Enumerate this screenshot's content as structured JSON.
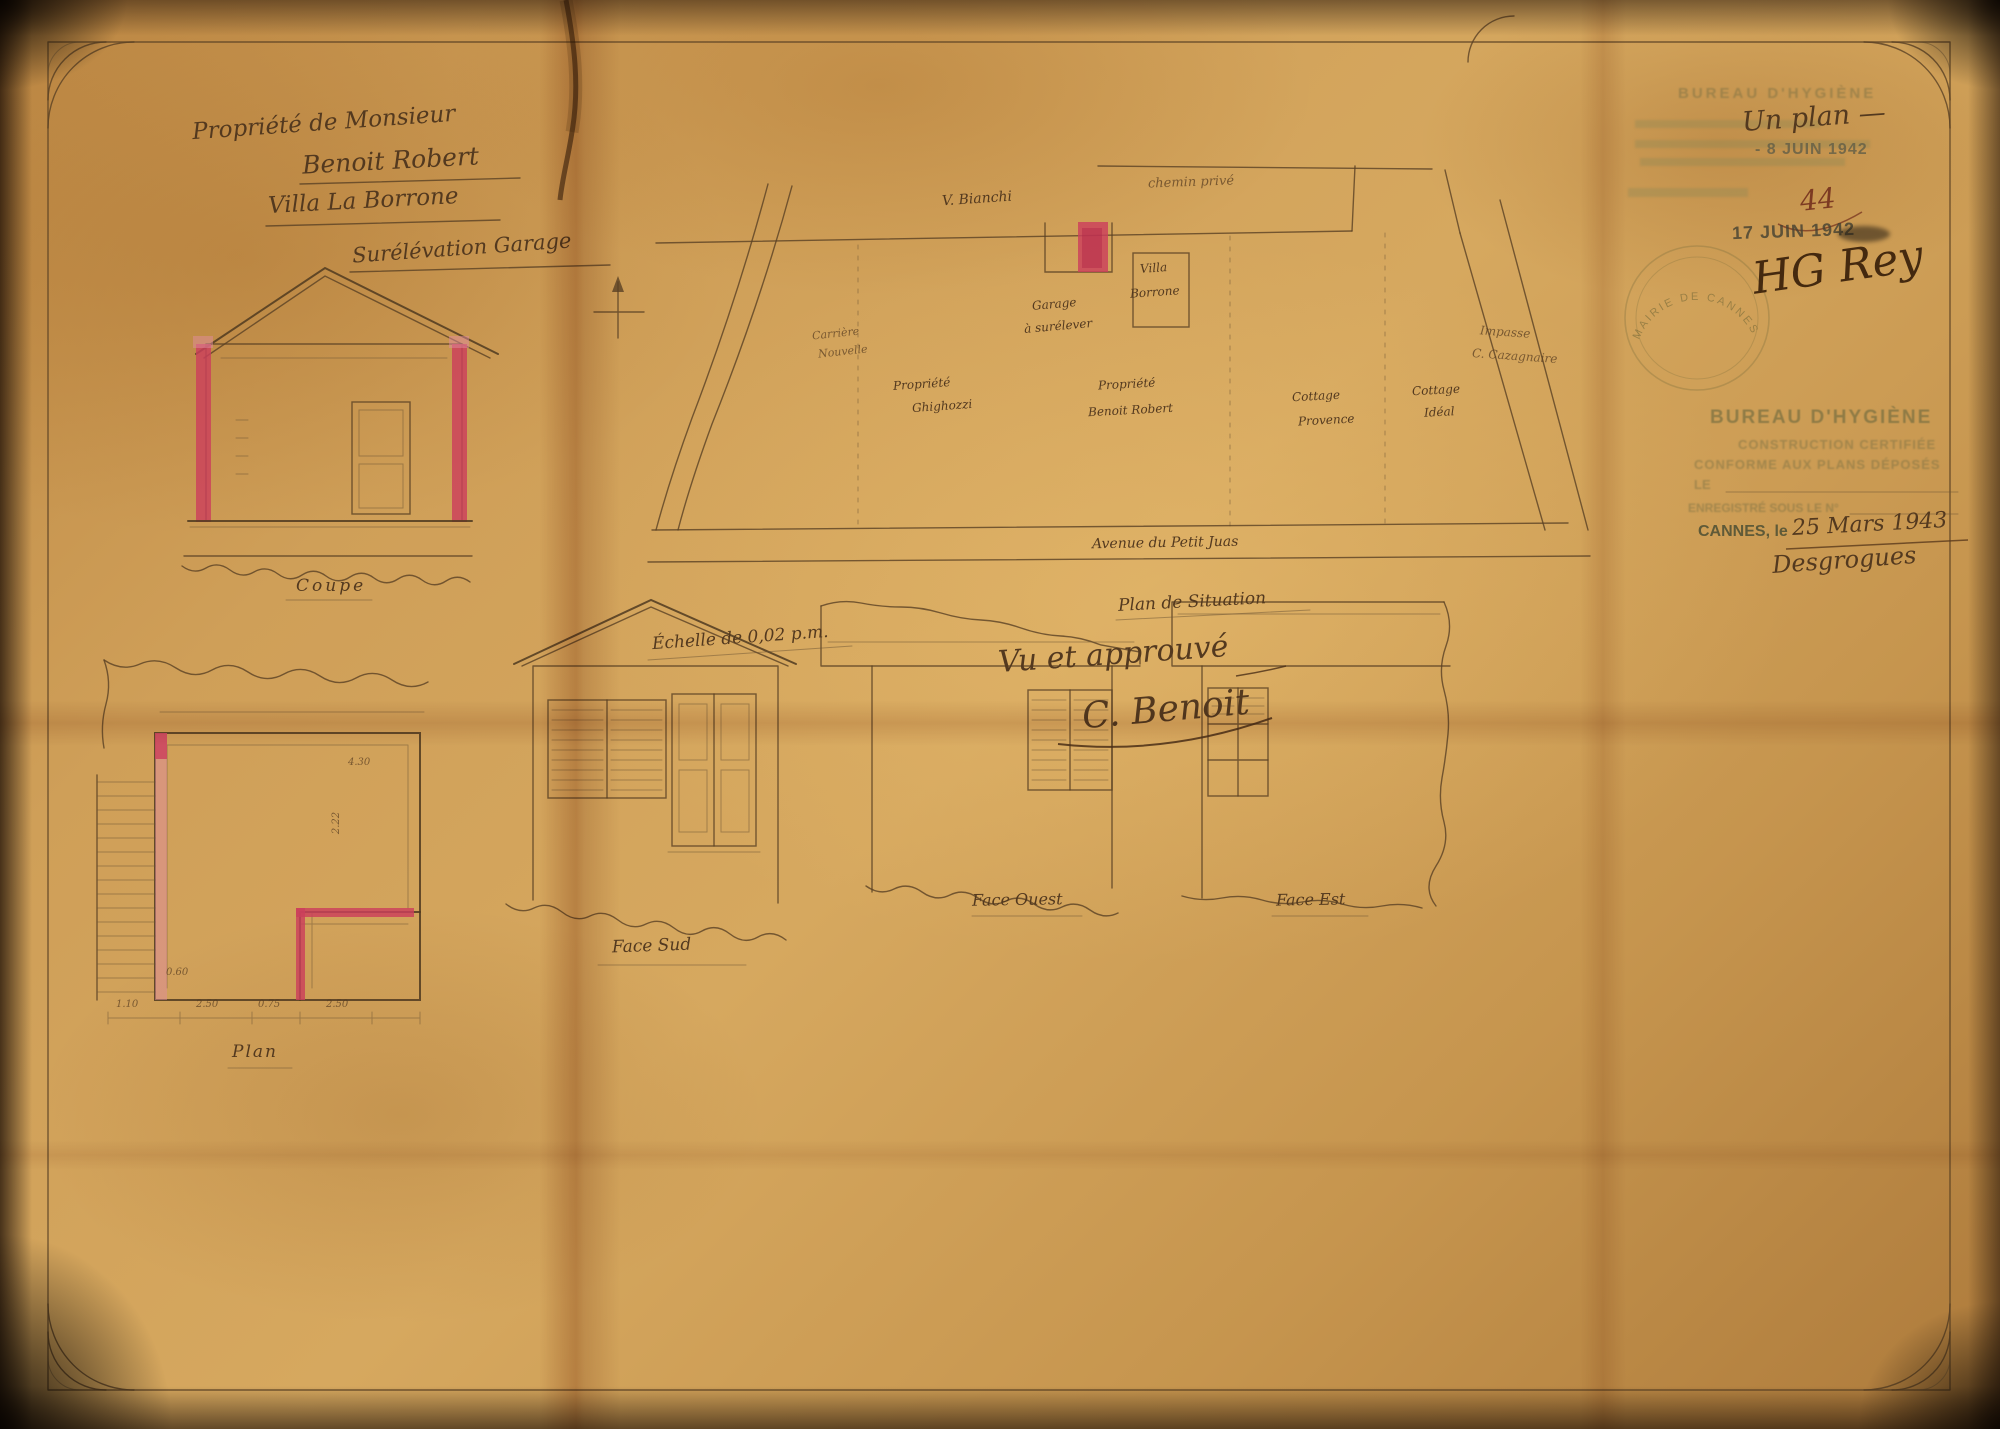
{
  "title_block": {
    "line1": "Propriété de Monsieur",
    "line2": "Benoit Robert",
    "line3": "Villa La Borrone",
    "line4": "Surélévation Garage"
  },
  "site_plan": {
    "road_top_left": "V. Bianchi",
    "road_top_right": "chemin privé",
    "curved_road_line1": "Carrière",
    "curved_road_line2": "Nouvelle",
    "garage_label_line1": "Garage",
    "garage_label_line2": "à surélever",
    "villa_label_line1": "Villa",
    "villa_label_line2": "Borrone",
    "parcel_left_line1": "Propriété",
    "parcel_left_line2": "Ghighozzi",
    "parcel_center_line1": "Propriété",
    "parcel_center_line2": "Benoit Robert",
    "parcel_right1_line1": "Cottage",
    "parcel_right1_line2": "Provence",
    "parcel_right2_line1": "Cottage",
    "parcel_right2_line2": "Idéal",
    "impasse_line1": "Impasse",
    "impasse_line2": "C. Cazagnaire",
    "avenue": "Avenue du Petit Juas",
    "caption": "Plan de Situation"
  },
  "stamps": {
    "faded_header": "BUREAU D'HYGIÈNE",
    "manuscript_count": "Un plan —",
    "date_received": "- 8 JUIN 1942",
    "file_number": "44",
    "date_second": "17 JUIN 1942",
    "signature_initials": "HG Rey",
    "round_stamp": "MAIRIE DE CANNES",
    "certification": {
      "title": "BUREAU D'HYGIÈNE",
      "line1": "CONSTRUCTION CERTIFIÉE",
      "line2": "CONFORME AUX PLANS DÉPOSÉS",
      "line3": "LE",
      "line4": "ENREGISTRÉ SOUS LE N°",
      "city_line": "CANNES, le",
      "date_manuscript": "25 Mars 1943",
      "signature": "Desgrogues"
    }
  },
  "approval": {
    "line1": "Vu et approuvé",
    "signature": "C. Benoit"
  },
  "scale_note": "Échelle de 0,02 p.m.",
  "captions": {
    "coupe": "Coupe",
    "face_sud": "Face Sud",
    "face_ouest": "Face Ouest",
    "face_est": "Face Est",
    "plan": "Plan"
  },
  "floor_plan": {
    "dims": [
      "1.10",
      "2.50",
      "0.75",
      "2.50",
      "0.60",
      "2.22",
      "4.30"
    ]
  },
  "colors": {
    "paper": "#cf9f58",
    "ink": "#5a4124",
    "red_wash": "#cc3f5c",
    "stamp_green": "#6f6a40"
  }
}
